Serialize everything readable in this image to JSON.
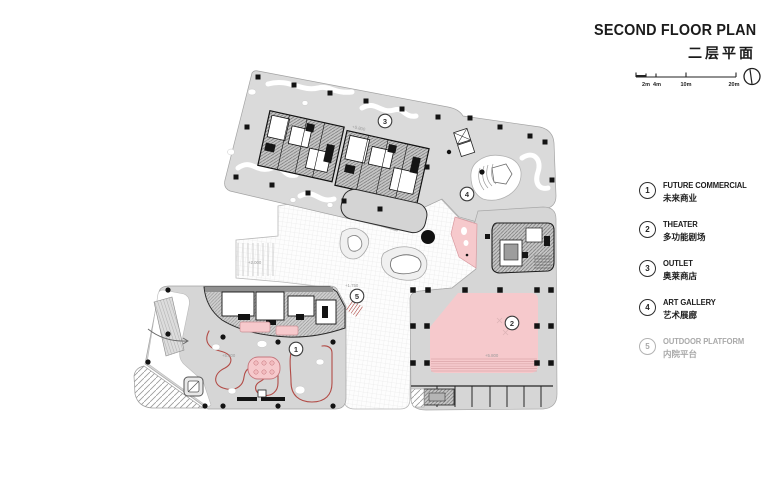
{
  "header": {
    "title": "SECOND FLOOR PLAN",
    "subtitle": "二层平面"
  },
  "scale_bar": {
    "labels": [
      "2m",
      "4m",
      "10m",
      "20m"
    ]
  },
  "legend": {
    "items": [
      {
        "num": "1",
        "en": "FUTURE COMMERCIAL",
        "zh": "未来商业"
      },
      {
        "num": "2",
        "en": "THEATER",
        "zh": "多功能剧场"
      },
      {
        "num": "3",
        "en": "OUTLET",
        "zh": "奥莱商店"
      },
      {
        "num": "4",
        "en": "ART GALLERY",
        "zh": "艺术展廊"
      },
      {
        "num": "5",
        "en": "OUTDOOR PLATFORM",
        "zh": "内院平台"
      }
    ]
  },
  "plan": {
    "markers": [
      {
        "num": "1"
      },
      {
        "num": "2"
      },
      {
        "num": "3"
      },
      {
        "num": "4"
      },
      {
        "num": "5"
      }
    ],
    "elevations": [
      {
        "text": "+5.800"
      },
      {
        "text": "+1.750"
      },
      {
        "text": "+5.800"
      },
      {
        "text": "+5.800"
      },
      {
        "text": "+2.000"
      }
    ]
  },
  "colors": {
    "block_gray": "#d7d7d7",
    "theater_pink": "#f6c9cc",
    "path_red": "#b24b46",
    "ink": "#1c1c1c",
    "muted": "#a8a8a8"
  }
}
